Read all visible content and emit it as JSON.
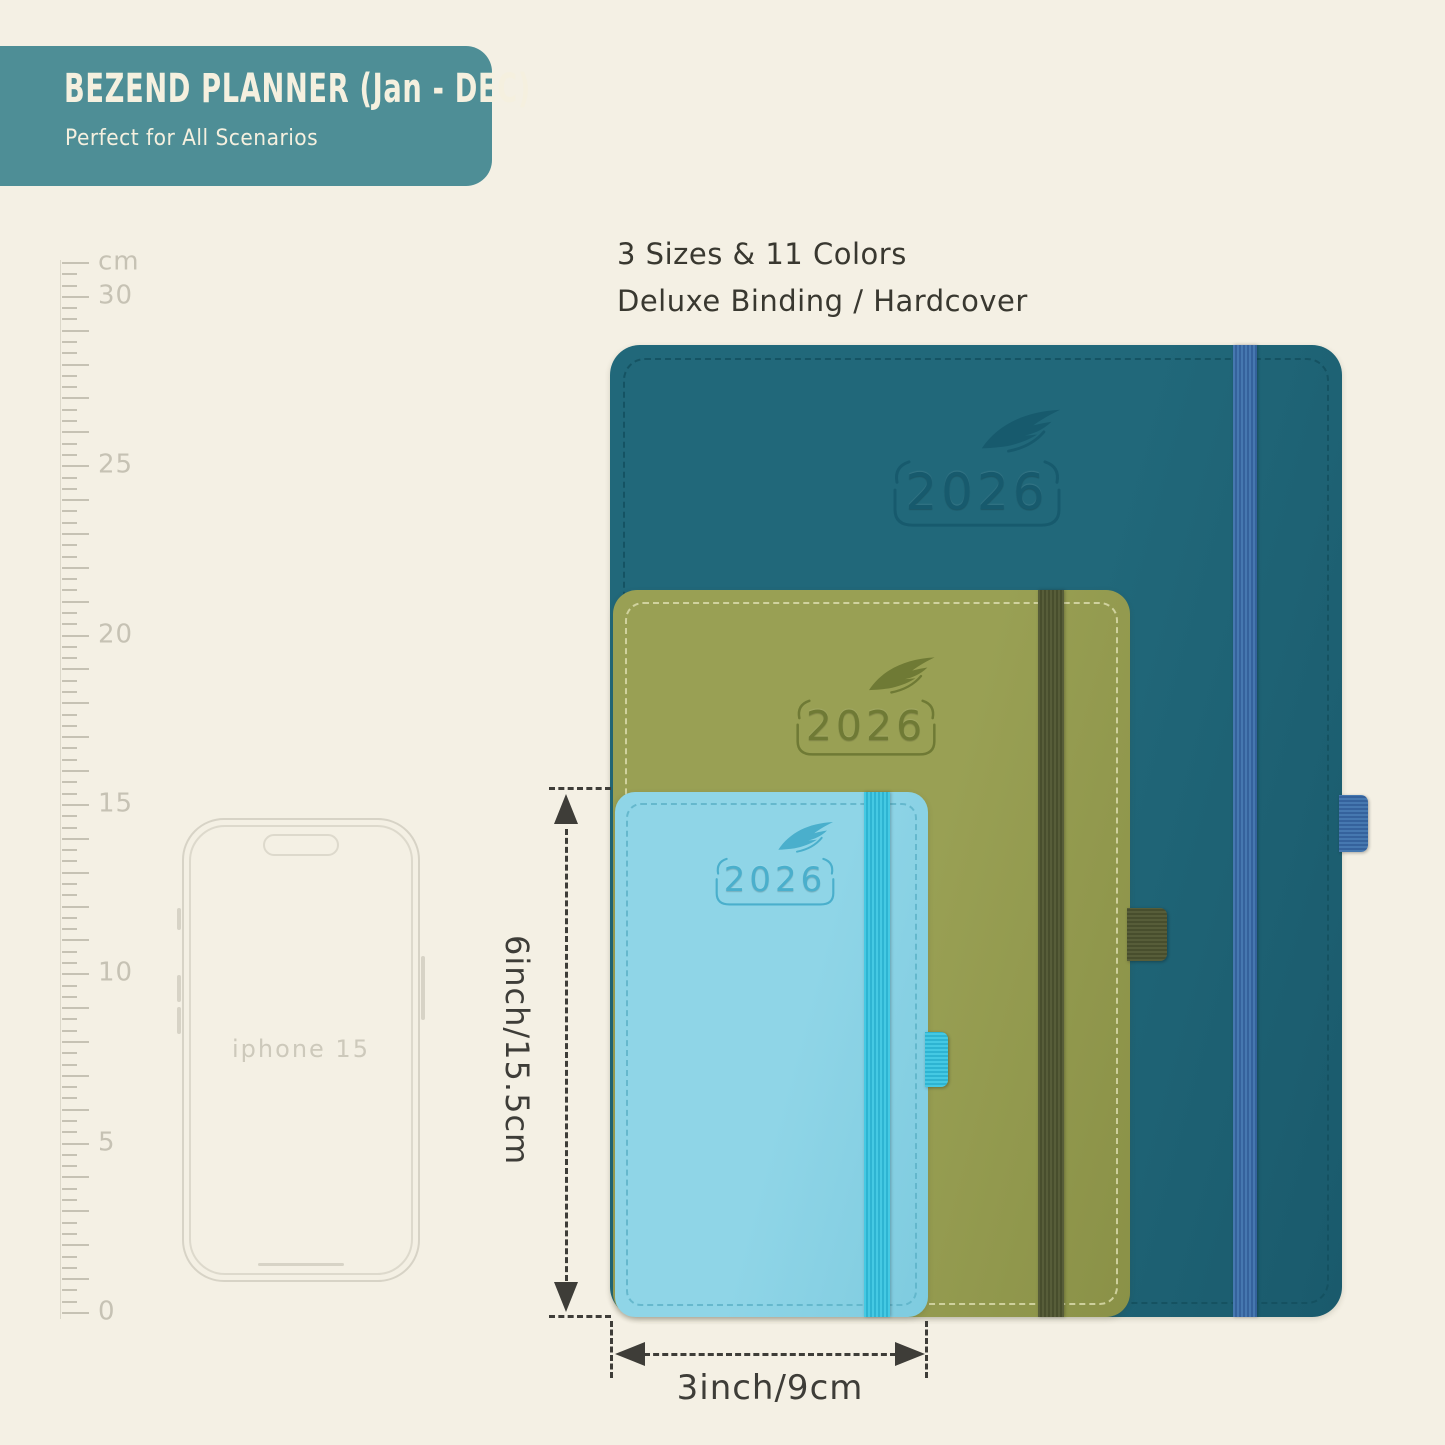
{
  "background_color": "#f4f0e4",
  "banner": {
    "title": "BEZEND PLANNER (Jan - DEC)",
    "subtitle": "Perfect for All Scenarios",
    "bg_color": "#4e8e96",
    "text_color": "#f5f0df"
  },
  "headline": {
    "line1": "3 Sizes & 11 Colors",
    "line2": "Deluxe Binding / Hardcover",
    "text_color": "#393830"
  },
  "ruler": {
    "max_cm": 31,
    "color": "#c6c2b4",
    "labels": [
      {
        "cm": 31,
        "text": "cm"
      },
      {
        "cm": 30,
        "text": "30"
      },
      {
        "cm": 25,
        "text": "25"
      },
      {
        "cm": 20,
        "text": "20"
      },
      {
        "cm": 15,
        "text": "15"
      },
      {
        "cm": 10,
        "text": "10"
      },
      {
        "cm": 5,
        "text": "5"
      },
      {
        "cm": 0,
        "text": "0"
      }
    ]
  },
  "phone": {
    "label": "iphone 15",
    "outline_color": "#d7d3c6"
  },
  "planners": [
    {
      "size": "large",
      "year": "2026",
      "cover_color": "#21687a",
      "cover_shade": "#1a5a6c",
      "stitch_color": "#14505f",
      "elastic_color": "#4678b0",
      "elastic_shade": "#35629c",
      "logo_color": "#175a6d"
    },
    {
      "size": "medium",
      "year": "2026",
      "cover_color": "#99a054",
      "cover_shade": "#8a9147",
      "stitch_color": "#dadbab",
      "elastic_color": "#575d39",
      "elastic_shade": "#484e2d",
      "logo_color": "#6f7a35"
    },
    {
      "size": "small",
      "year": "2026",
      "cover_color": "#8fd5e7",
      "cover_shade": "#7ecbdf",
      "stitch_color": "#5fb4c9",
      "elastic_color": "#45c9e3",
      "elastic_shade": "#2eb4d2",
      "logo_color": "#4aafcc"
    }
  ],
  "dimensions": {
    "height_label": "6inch/15.5cm",
    "width_label": "3inch/9cm",
    "color": "#3e3d38"
  }
}
